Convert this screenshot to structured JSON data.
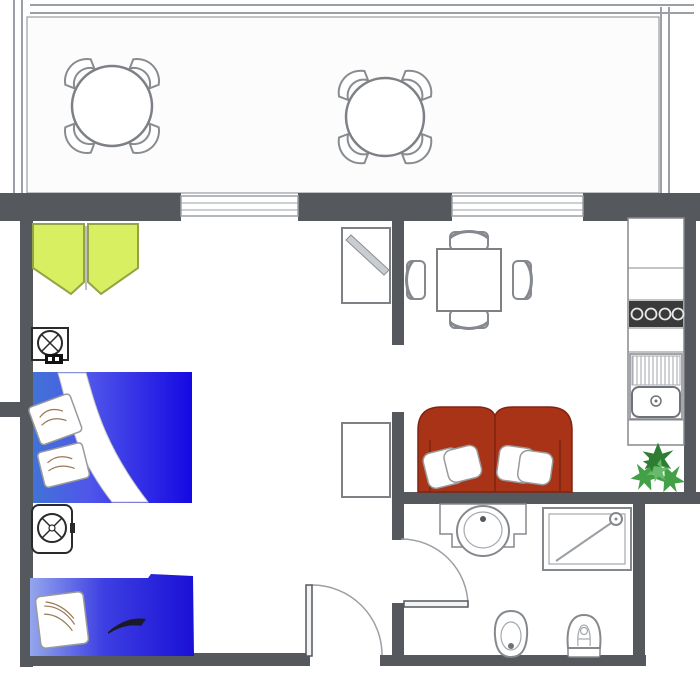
{
  "title": "apartment-floor-plan",
  "colors": {
    "wall": "#55585c",
    "outline": "#85898e",
    "hatch_line": "#aab0b5",
    "window_line": "#9aa0a6",
    "wardrobe_fill": "#d7ef60",
    "wardrobe_stroke": "#93a347",
    "bed_light": "#4173d6",
    "bed_mid": "#5056ea",
    "bed_deep": "#1509e2",
    "bed2_light": "#93a6ec",
    "bed2_mid": "#3d3fe2",
    "bed2_deep": "#1a10d6",
    "sofa_red": "#a93317",
    "sofa_stroke": "#7e2410",
    "pillow_line": "#997755",
    "plant_dark": "#2e7d32",
    "plant_mid": "#43a047",
    "plant_light": "#66bb6a",
    "stove_dark": "#3a3a3a",
    "fixture_stroke": "#2a2a2a",
    "dark_fold": "#1a1a28"
  },
  "plan": {
    "terrace": {
      "hatch": "diagonal-crosshatch",
      "tables": 2,
      "chairs_per_table": 4
    },
    "bedroom": {
      "items": [
        "wardrobe-open-doors",
        "ceiling-fixture-symbol",
        "double-bed",
        "nightstand-fixture-symbol",
        "single-bed"
      ]
    },
    "living_room": {
      "items": [
        "mirror-cabinet",
        "dining-table",
        "dining-chairs",
        "lower-cabinet",
        "two-seat-sofa"
      ],
      "dining_chairs": 4
    },
    "kitchen": {
      "items": [
        "counter",
        "cooktop-4-burners",
        "sink-with-drainboard",
        "potted-plant"
      ]
    },
    "bathroom": {
      "items": [
        "washbasin",
        "shower-cabin",
        "toilet",
        "bidet"
      ]
    },
    "doors": [
      "entry-door-bottom",
      "bathroom-door"
    ],
    "windows": 2
  }
}
